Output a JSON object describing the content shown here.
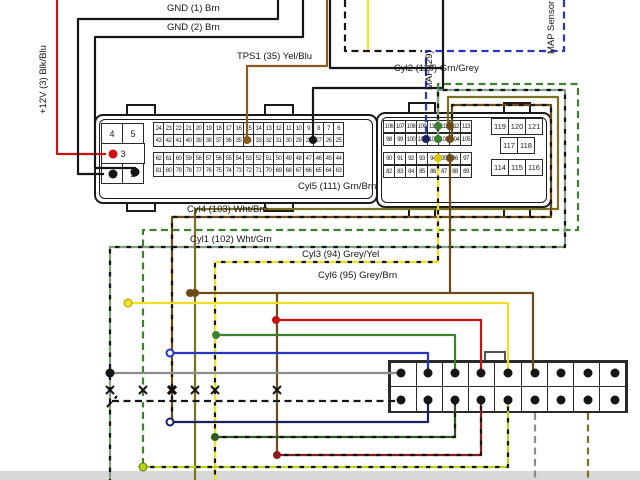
{
  "page": {
    "background": "#ffffff",
    "footer_band_color": "#d8d8d8"
  },
  "labels": {
    "plus12v": "+12V (3) Blk/Blu",
    "gnd1": "GND (1) Brn",
    "gnd2": "GND (2) Brn",
    "tps1": "TPS1 (35) Yel/Blu",
    "maf": "MAF (29)",
    "map_sensor": "MAP Sensor",
    "cyl2": "Cyl2 (110) Grn/Grey",
    "cyl5": "Cyl5 (111) Grn/Brn",
    "cyl4": "Cyl4 (103) Wht/Brn",
    "cyl1": "Cyl1 (102) Wht/Grn",
    "cyl3": "Cyl3 (94) Grey/Yel",
    "cyl6": "Cyl6 (95) Grey/Brn"
  },
  "ecu_connector_left": {
    "aux_rows": [
      [
        "4",
        "5"
      ],
      [
        "3"
      ],
      [
        "1",
        "2"
      ]
    ],
    "rows": [
      [
        24,
        23,
        22,
        21,
        20,
        19,
        18,
        17,
        16,
        15,
        14,
        13,
        12,
        11,
        10,
        9,
        8,
        7,
        6
      ],
      [
        43,
        42,
        41,
        40,
        39,
        38,
        37,
        36,
        35,
        34,
        33,
        32,
        31,
        30,
        29,
        28,
        27,
        26,
        25
      ],
      [
        62,
        61,
        60,
        59,
        58,
        57,
        56,
        55,
        54,
        53,
        52,
        51,
        50,
        49,
        48,
        47,
        46,
        45,
        44
      ],
      [
        81,
        80,
        79,
        78,
        77,
        76,
        75,
        74,
        73,
        72,
        71,
        70,
        69,
        68,
        67,
        66,
        65,
        64,
        63
      ]
    ]
  },
  "ecu_connector_right": {
    "rows": [
      [
        106,
        107,
        108,
        109,
        110,
        111,
        112,
        113
      ],
      [
        98,
        99,
        100,
        101,
        102,
        103,
        104,
        105
      ],
      [
        90,
        91,
        92,
        93,
        94,
        95,
        96,
        97
      ],
      [
        82,
        83,
        84,
        85,
        86,
        87,
        88,
        89
      ]
    ],
    "aux_rows": [
      [
        "119",
        "120",
        "121"
      ],
      [
        "117",
        "118"
      ],
      [
        "114",
        "115",
        "116"
      ]
    ]
  },
  "igniter_connector": {
    "columns": 9,
    "rows": 2
  },
  "wires": [
    {
      "name": "supply-12v",
      "color": "red",
      "label": "+12V (3) Blk/Blu",
      "pin": 3
    },
    {
      "name": "ground-1",
      "color": "black",
      "label": "GND (1) Brn",
      "pin": 1
    },
    {
      "name": "ground-2",
      "color": "black",
      "label": "GND (2) Brn",
      "pin": 2
    },
    {
      "name": "tps1",
      "color": "brown",
      "label": "TPS1 (35) Yel/Blu",
      "pin": 35
    },
    {
      "name": "maf",
      "color": "black",
      "label": "MAF (29)",
      "pin": 29
    },
    {
      "name": "map-sensor",
      "color": "blue dashed",
      "label": "MAP Sensor",
      "pin": 101
    },
    {
      "name": "cyl1",
      "color": "grey-green dashed",
      "label": "Cyl1 (102) Wht/Grn",
      "pin": 102
    },
    {
      "name": "cyl2",
      "color": "green dashed",
      "label": "Cyl2 (110) Grn/Grey",
      "pin": 110
    },
    {
      "name": "cyl3",
      "color": "yellow dashed",
      "label": "Cyl3 (94) Grey/Yel",
      "pin": 94
    },
    {
      "name": "cyl4",
      "color": "brown dashed",
      "label": "Cyl4 (103) Wht/Brn",
      "pin": 103
    },
    {
      "name": "cyl5",
      "color": "olive",
      "label": "Cyl5 (111) Grn/Brn",
      "pin": 111
    },
    {
      "name": "cyl6",
      "color": "brown",
      "label": "Cyl6 (95) Grey/Brn",
      "pin": 95
    }
  ],
  "palette": {
    "red": "#cc1111",
    "black": "#151515",
    "brown": "#8a5a22",
    "dark_brown": "#6e4a16",
    "olive": "#7d7020",
    "yellow": "#f0e020",
    "blue": "#2636c0",
    "navy": "#1c2060",
    "green": "#3d8030",
    "dark_green": "#2d5a1e",
    "dark_red": "#8b1c1c",
    "grey": "#8c8c8c",
    "grey_green": "#7fa07f",
    "yellow_green": "#b8d21a"
  }
}
